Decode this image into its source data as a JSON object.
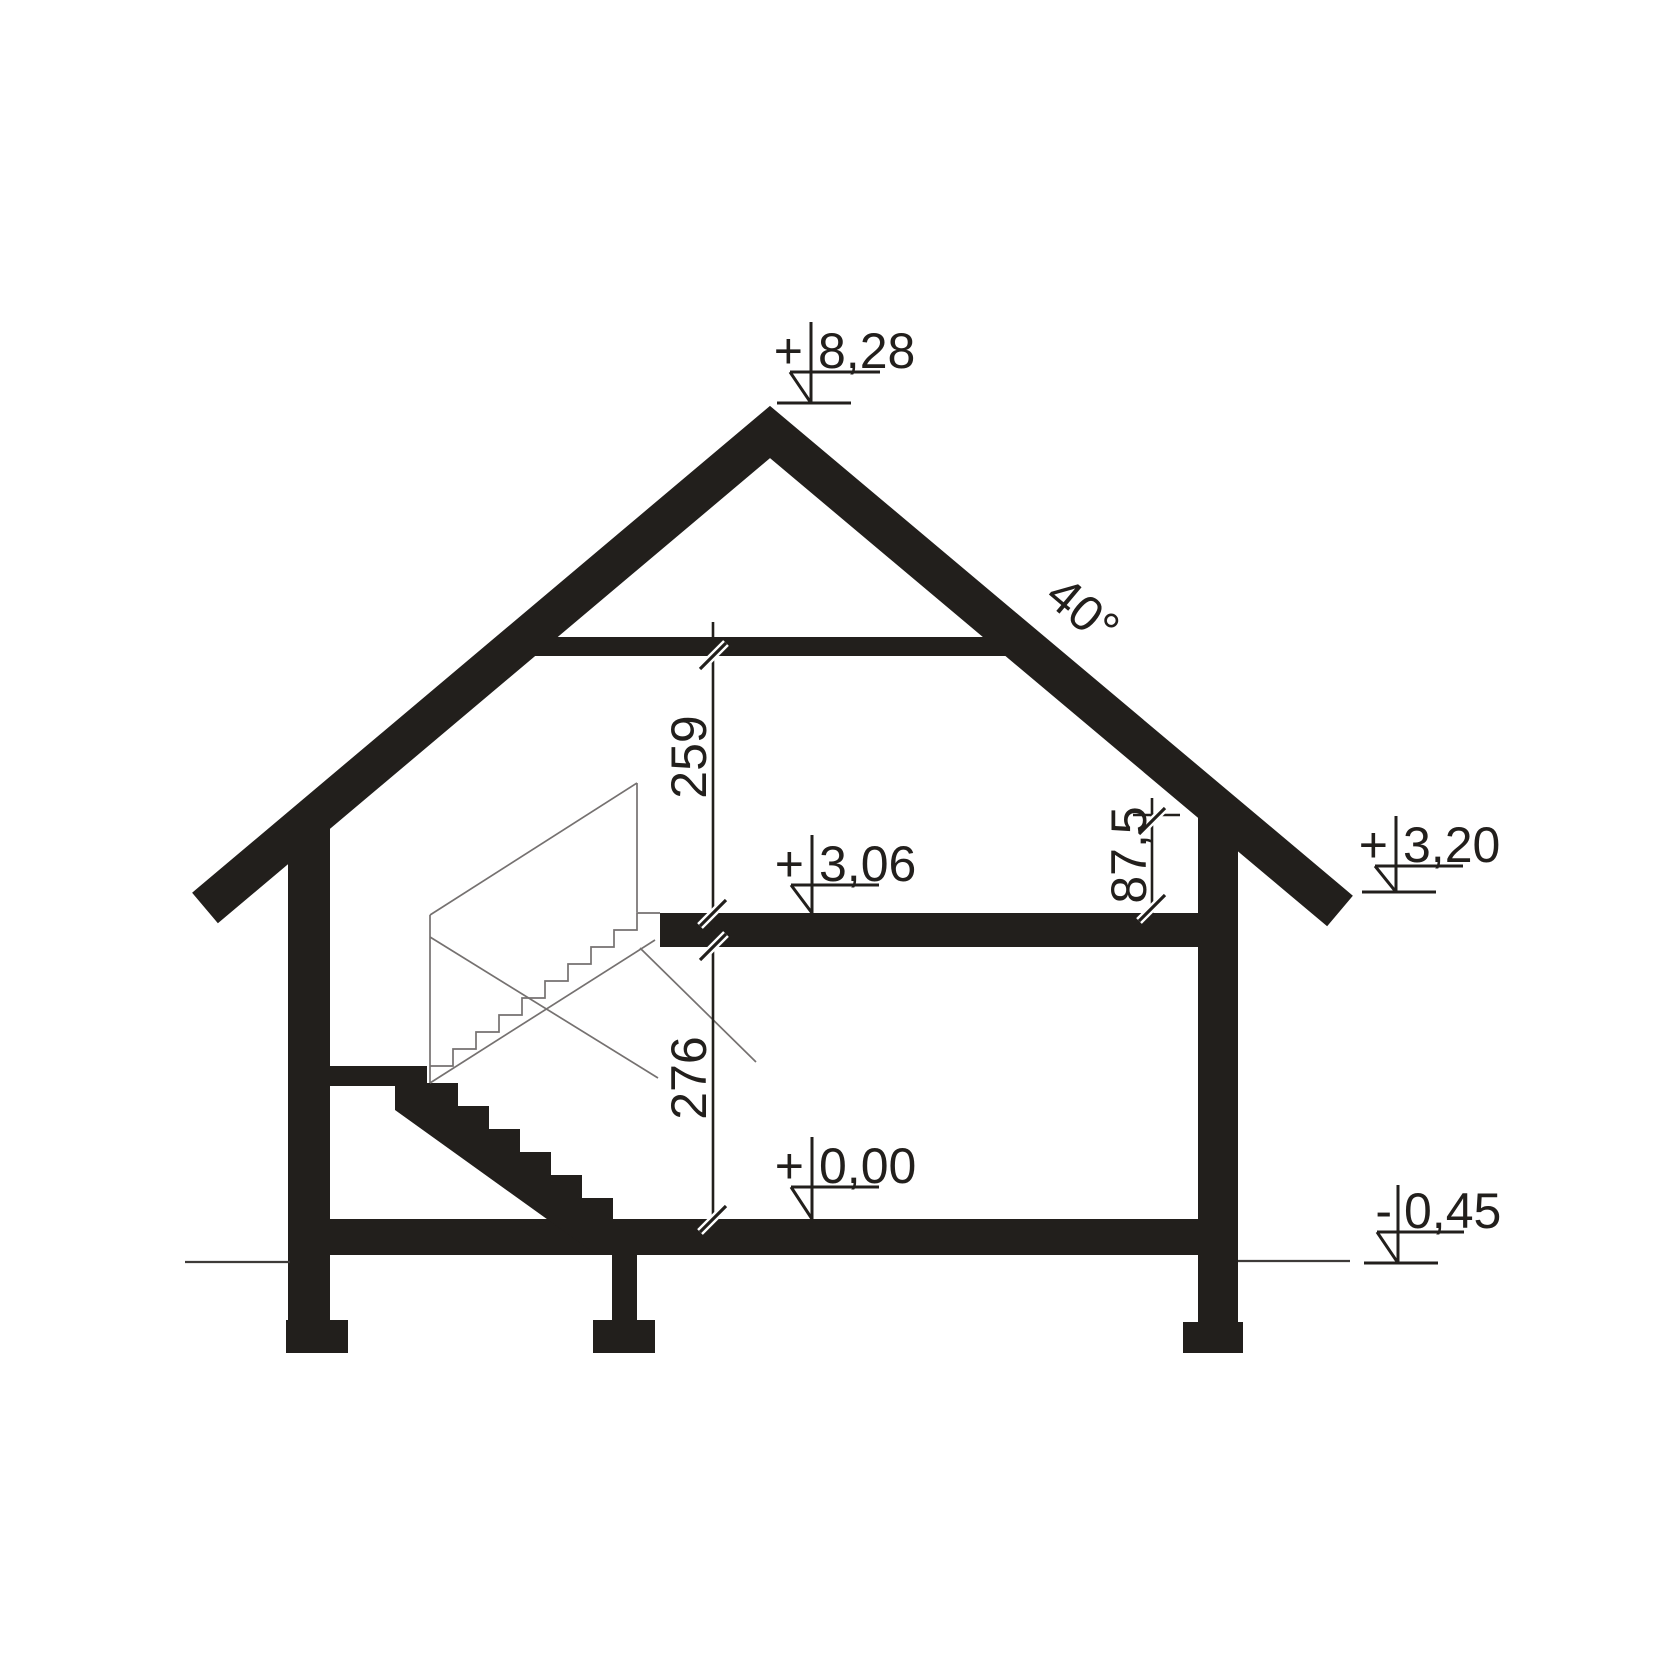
{
  "drawing": {
    "kind": "house-cross-section",
    "levels": {
      "ridge": {
        "sign": "+",
        "value": "8,28"
      },
      "attic_floor": {
        "sign": "+",
        "value": "3,06"
      },
      "eaves": {
        "sign": "+",
        "value": "3,20"
      },
      "ground_floor": {
        "sign": "+",
        "value": "0,00"
      },
      "terrain": {
        "sign": "-",
        "value": "0,45"
      }
    },
    "dimensions": {
      "attic_room_height": "259",
      "ground_floor_room_height": "276",
      "knee_wall_height": "87,5",
      "roof_pitch": "40°"
    },
    "colors": {
      "ink": "#221f1c",
      "thin_line": "#757170",
      "background": "#ffffff"
    }
  }
}
